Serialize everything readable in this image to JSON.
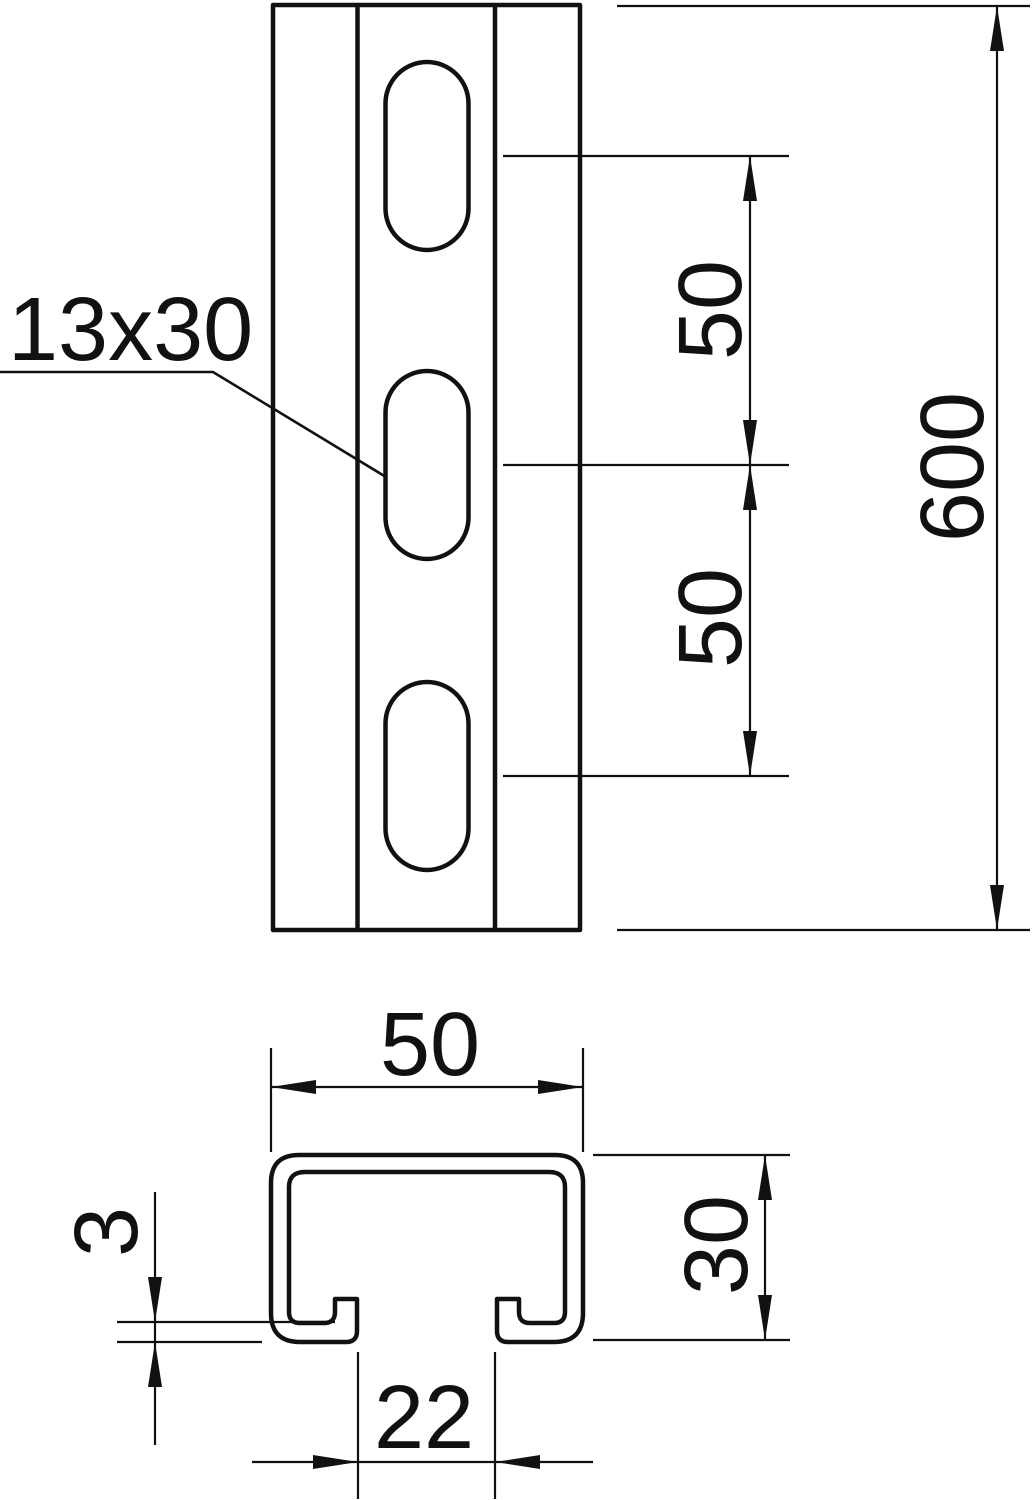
{
  "drawing": {
    "description": "Technical dimension drawing of a slotted C-profile mounting rail: front view with oblong slots (top) and cross-section profile (bottom)",
    "colors": {
      "line": "#111111",
      "background": "#ffffff"
    },
    "front_view": {
      "slot_size_label": "13x30",
      "slot_pitch_dim_1": "50",
      "slot_pitch_dim_2": "50",
      "total_length_dim": "600"
    },
    "section_view": {
      "width_dim": "50",
      "height_dim": "30",
      "opening_dim": "22",
      "thickness_dim": "3"
    }
  }
}
